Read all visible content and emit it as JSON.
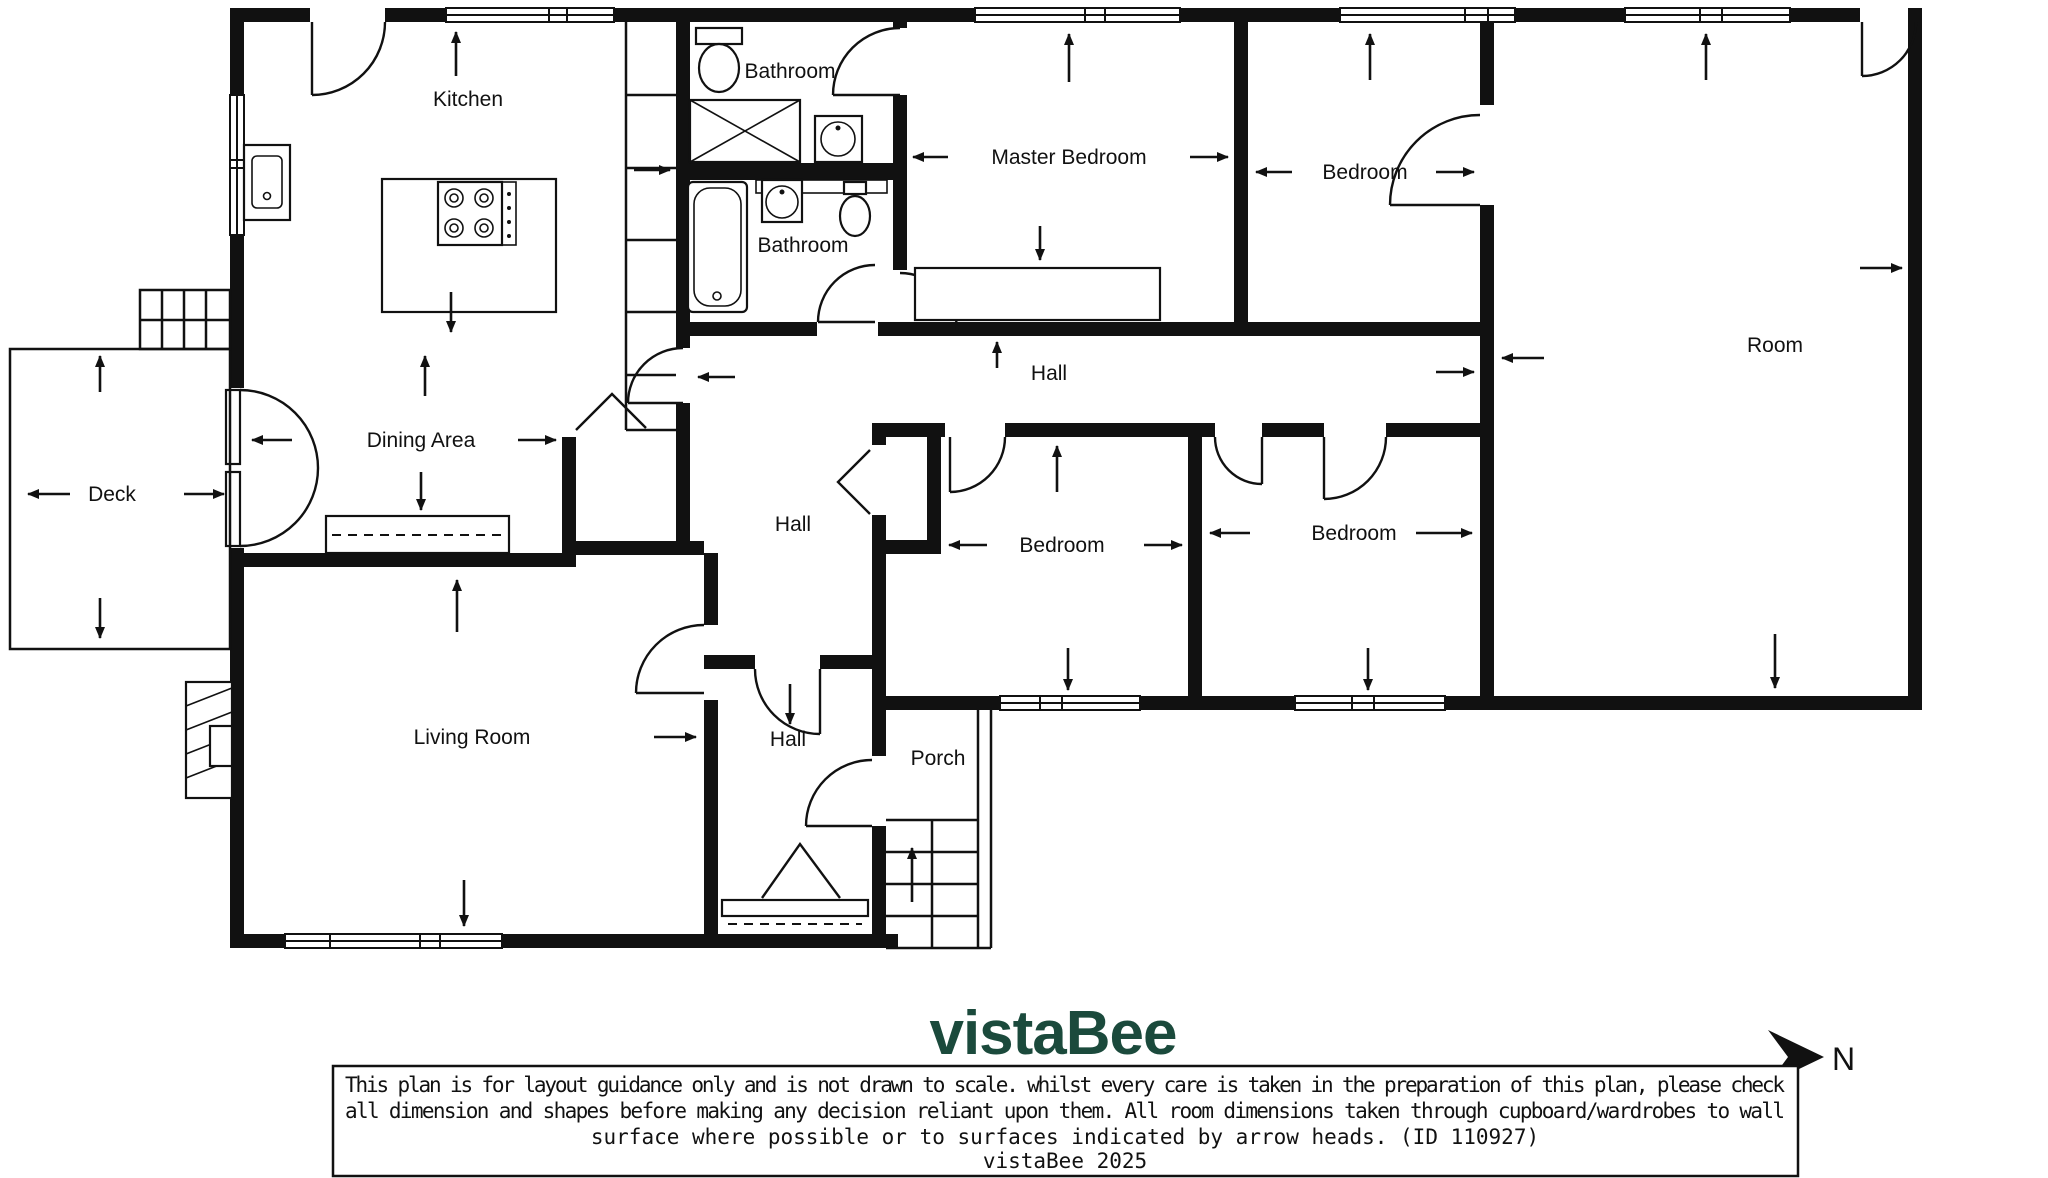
{
  "plan": {
    "rooms": [
      {
        "id": "kitchen",
        "label": "Kitchen"
      },
      {
        "id": "bathroom-top",
        "label": "Bathroom"
      },
      {
        "id": "master-bedroom",
        "label": "Master Bedroom"
      },
      {
        "id": "bedroom-top-right",
        "label": "Bedroom"
      },
      {
        "id": "bathroom-mid",
        "label": "Bathroom"
      },
      {
        "id": "room",
        "label": "Room"
      },
      {
        "id": "hall-upper",
        "label": "Hall"
      },
      {
        "id": "dining-area",
        "label": "Dining Area"
      },
      {
        "id": "deck",
        "label": "Deck"
      },
      {
        "id": "hall-mid",
        "label": "Hall"
      },
      {
        "id": "bedroom-mid-left",
        "label": "Bedroom"
      },
      {
        "id": "bedroom-mid-right",
        "label": "Bedroom"
      },
      {
        "id": "living-room",
        "label": "Living Room"
      },
      {
        "id": "hall-lower",
        "label": "Hall"
      },
      {
        "id": "porch",
        "label": "Porch"
      }
    ]
  },
  "footer": {
    "logo": "vistaBee",
    "north_label": "N"
  },
  "disclaimer": {
    "line1": "This plan is for layout guidance only and is not drawn to scale. whilst every care is taken in the preparation of this plan, please check",
    "line2": "all dimension and shapes before making any decision reliant upon them. All room dimensions taken through cupboard/wardrobes to wall",
    "line3": "surface where possible or to surfaces indicated by arrow heads. (ID 110927)",
    "credit": "vistaBee 2025"
  },
  "colors": {
    "ink": "#111111",
    "logo_green": "#1b4a3c"
  }
}
